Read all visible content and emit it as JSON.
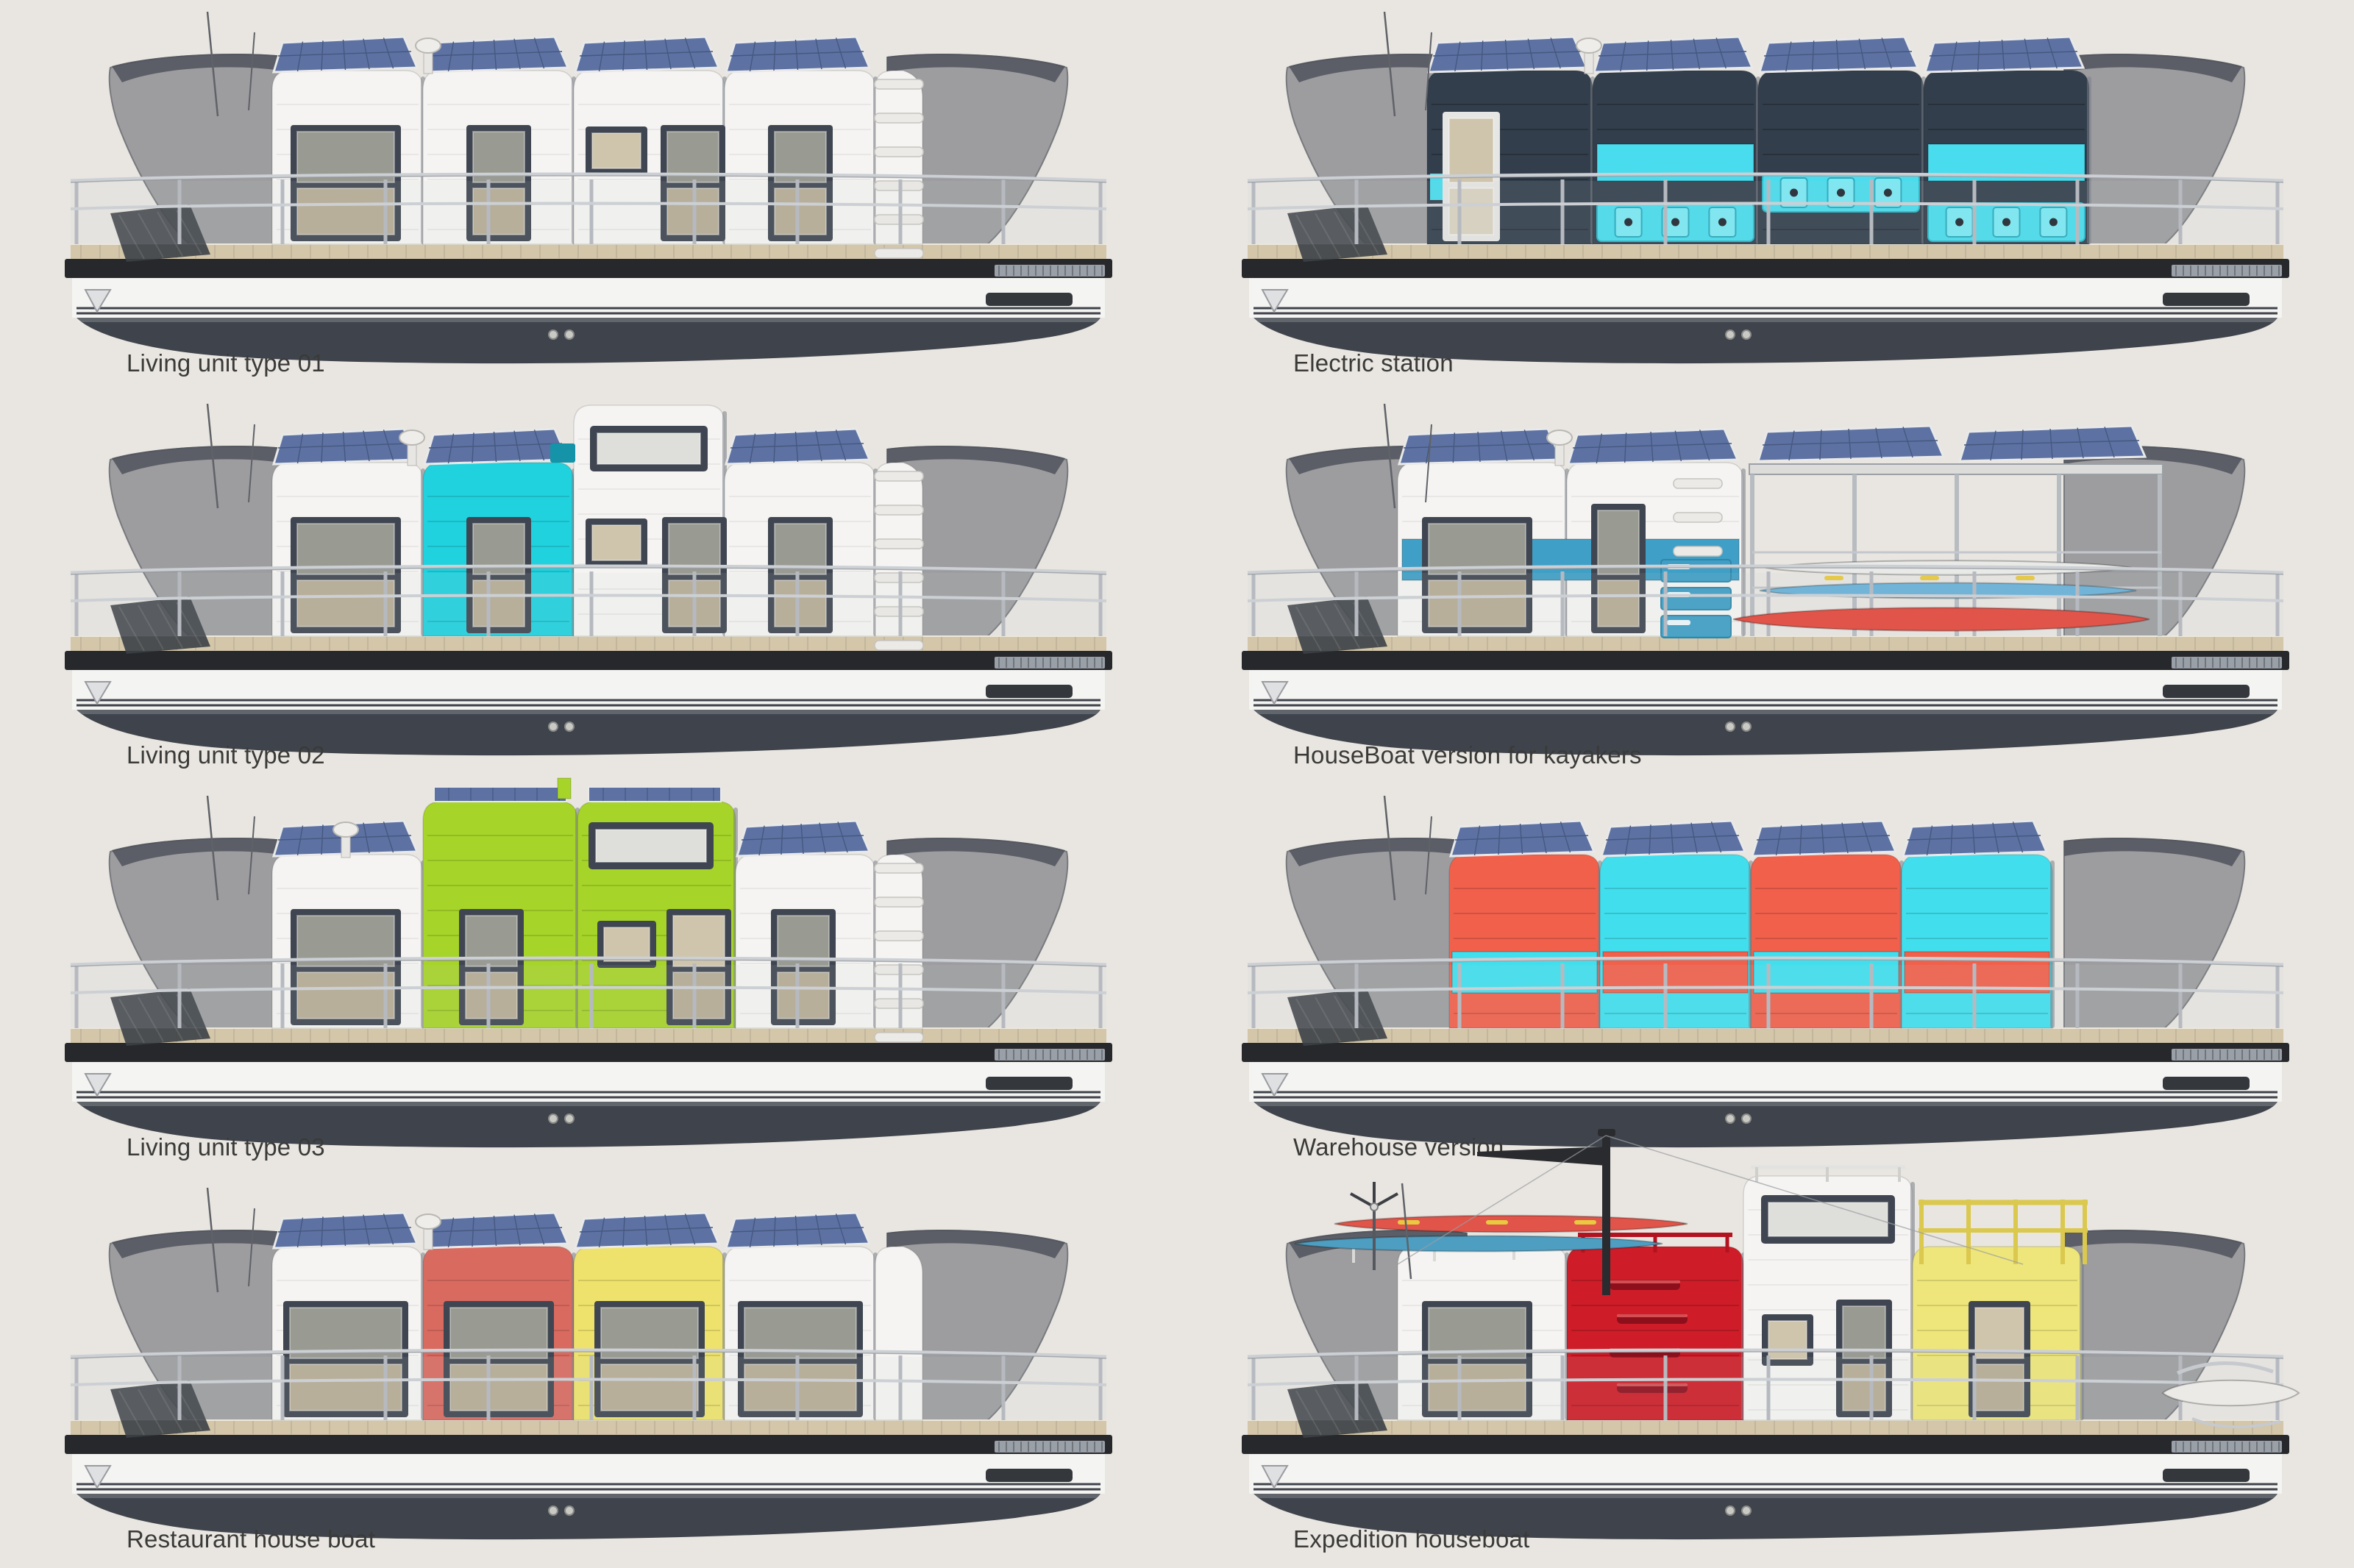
{
  "page": {
    "background": "#e9e6e1",
    "caption_color": "#3a3a38"
  },
  "palette": {
    "hull_dark": "#3f444c",
    "hull_fascia": "#27282c",
    "hull_white": "#f4f4f2",
    "hull_stripe": "#3f434b",
    "deck_wood": "#d3c6a9",
    "deck_line": "#a89a7d",
    "canopy_gray": "#8f9094",
    "canopy_edge": "#62656b",
    "canopy_top": "#4b4f57",
    "cabin_white": "#f5f4f2",
    "window_frame": "#3f4651",
    "window_frame_light": "#e6e6e4",
    "glass_upper": "#999a91",
    "glass_lower": "#b7ac95",
    "glass_tan": "#cfc4ac",
    "solar_blue": "#5d72a3",
    "solar_grid": "#46587f",
    "solar_frame": "#e9e9e9",
    "railing": "#ccd0d4",
    "railing_post": "#b6bac0",
    "metal_dark": "#2a2b2e",
    "electric_navy": "#333e4c",
    "electric_cyan": "#49dcee",
    "type02_cyan": "#20d2de",
    "kayaker_blue": "#3f9fc6",
    "lime_green": "#a6d428",
    "warehouse_coral": "#f1604b",
    "warehouse_cyan": "#41dfee",
    "restaurant_coral": "#d96a60",
    "restaurant_yellow": "#eee26c",
    "expedition_red": "#ce1d28",
    "expedition_yellow": "#eee67a",
    "kayak_red": "#e0544a",
    "kayak_blue": "#69b2d8",
    "kayak_white": "#e9eae8",
    "paddle_yellow": "#e8c93f"
  },
  "boats": [
    {
      "id": "living-unit-type-01",
      "variant": "living01",
      "caption": "Living unit type 01",
      "accents": [
        "#f5f4f2"
      ],
      "features": [
        "solar-panels",
        "roof-vent",
        "antennas",
        "deck-railing"
      ]
    },
    {
      "id": "electric-station",
      "variant": "electric",
      "caption": "Electric station",
      "accents": [
        "#333e4c",
        "#49dcee"
      ],
      "features": [
        "solar-panels",
        "charging-sockets",
        "cyan-stripes"
      ]
    },
    {
      "id": "living-unit-type-02",
      "variant": "living02",
      "caption": "Living unit type 02",
      "accents": [
        "#20d2de",
        "#f5f4f2"
      ],
      "features": [
        "solar-panels",
        "two-story-tower",
        "cyan-module"
      ]
    },
    {
      "id": "houseboat-version-for-kayakers",
      "variant": "kayakers",
      "caption": "HouseBoat version for kayakers",
      "accents": [
        "#3f9fc6",
        "#e0544a",
        "#69b2d8"
      ],
      "features": [
        "solar-canopy",
        "kayak-rack",
        "storage-drawers"
      ]
    },
    {
      "id": "living-unit-type-03",
      "variant": "living03",
      "caption": "Living unit type 03",
      "accents": [
        "#a6d428",
        "#f5f4f2"
      ],
      "features": [
        "solar-panels",
        "two-story-lime-tower"
      ]
    },
    {
      "id": "warehouse-version",
      "variant": "warehouse",
      "caption": "Warehouse version",
      "accents": [
        "#f1604b",
        "#41dfee"
      ],
      "features": [
        "solar-panels",
        "windowless-cargo-modules",
        "alternating-color-bands"
      ]
    },
    {
      "id": "restaurant-house-boat",
      "variant": "restaurant",
      "caption": "Restaurant house boat",
      "accents": [
        "#d96a60",
        "#eee26c",
        "#f5f4f2"
      ],
      "features": [
        "solar-panels",
        "panoramic-windows"
      ]
    },
    {
      "id": "expedition-houseboat",
      "variant": "expedition",
      "caption": "Expedition houseboat",
      "accents": [
        "#ce1d28",
        "#eee67a",
        "#f5f4f2"
      ],
      "features": [
        "roof-kayaks",
        "mast-and-boom",
        "wind-turbine",
        "gear-drawers",
        "roof-terrace-railing",
        "dinghy"
      ]
    }
  ]
}
